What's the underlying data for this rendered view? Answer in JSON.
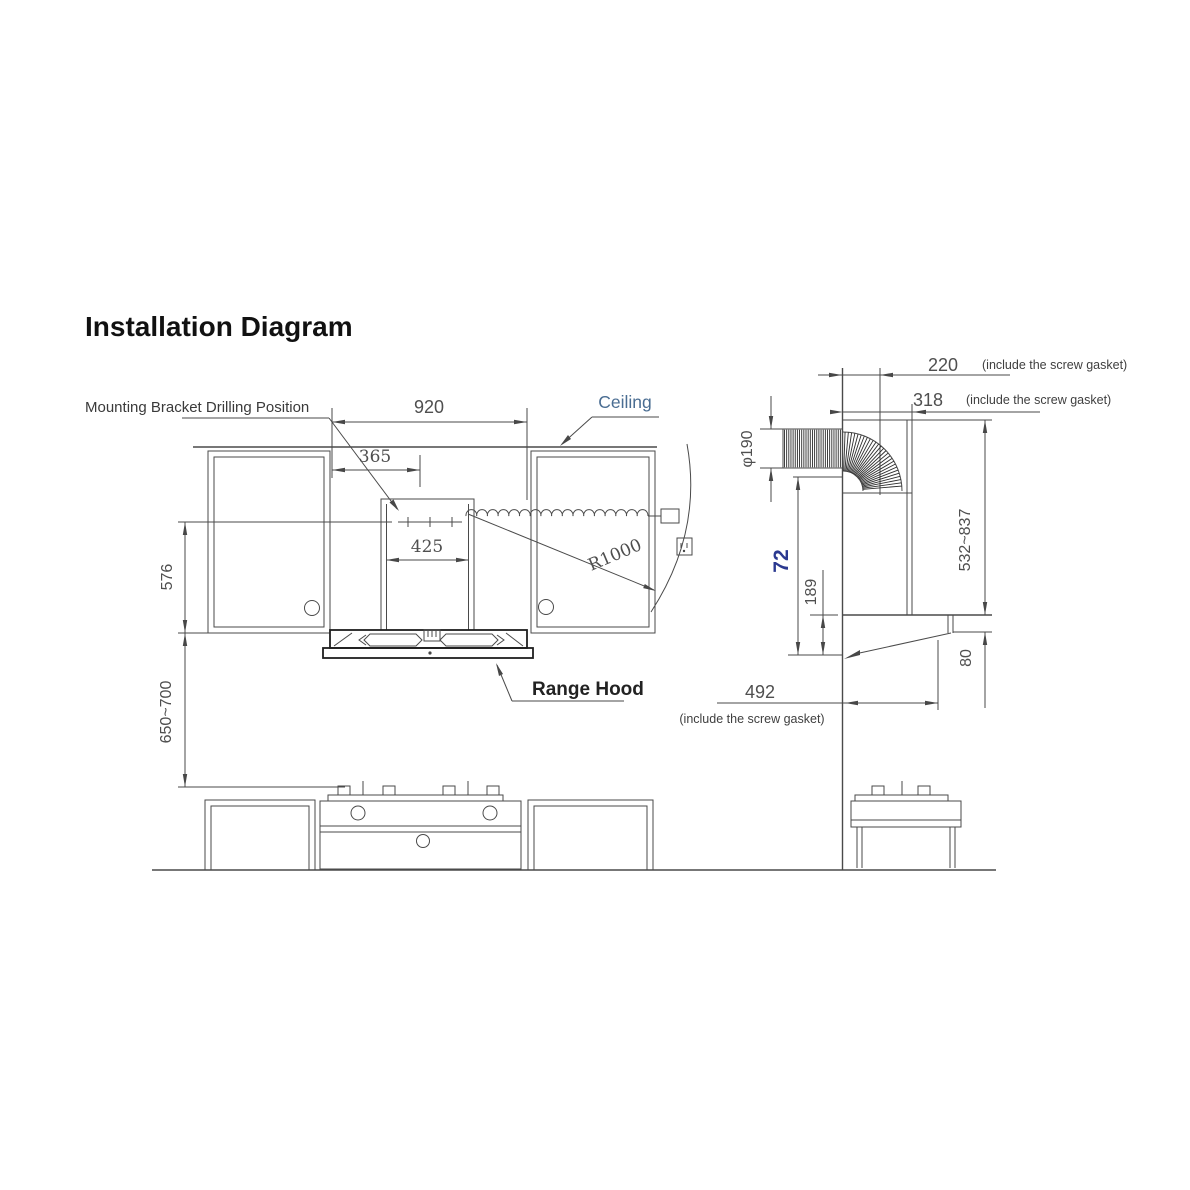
{
  "title": "Installation Diagram",
  "front_view": {
    "labels": {
      "mounting_bracket": "Mounting Bracket Drilling Position",
      "ceiling": "Ceiling",
      "range_hood": "Range Hood"
    },
    "dimensions": {
      "cabinet_opening_width": "920",
      "bracket_offset": "365",
      "chimney_width": "425",
      "cabinet_side_height": "576",
      "hood_to_cooktop_height": "650~700",
      "power_cord_radius": "R1000"
    }
  },
  "side_view": {
    "dimensions": {
      "duct_top_depth": "220",
      "duct_top_depth_note": "(include the screw gasket)",
      "chimney_depth": "318",
      "chimney_depth_note": "(include the screw gasket)",
      "duct_diameter": "φ190",
      "body_height": "72",
      "lower_section_height": "189",
      "chimney_height_range": "532~837",
      "hood_front_height": "80",
      "hood_depth": "492",
      "hood_depth_note": "(include the screw gasket)"
    }
  },
  "colors": {
    "line": "#4a4a4a",
    "dark_line": "#1f1f1f",
    "dim_text": "#4f4f4f",
    "label_blue": "#4a6d92",
    "accent_navy": "#2b3990",
    "title": "#111111"
  }
}
